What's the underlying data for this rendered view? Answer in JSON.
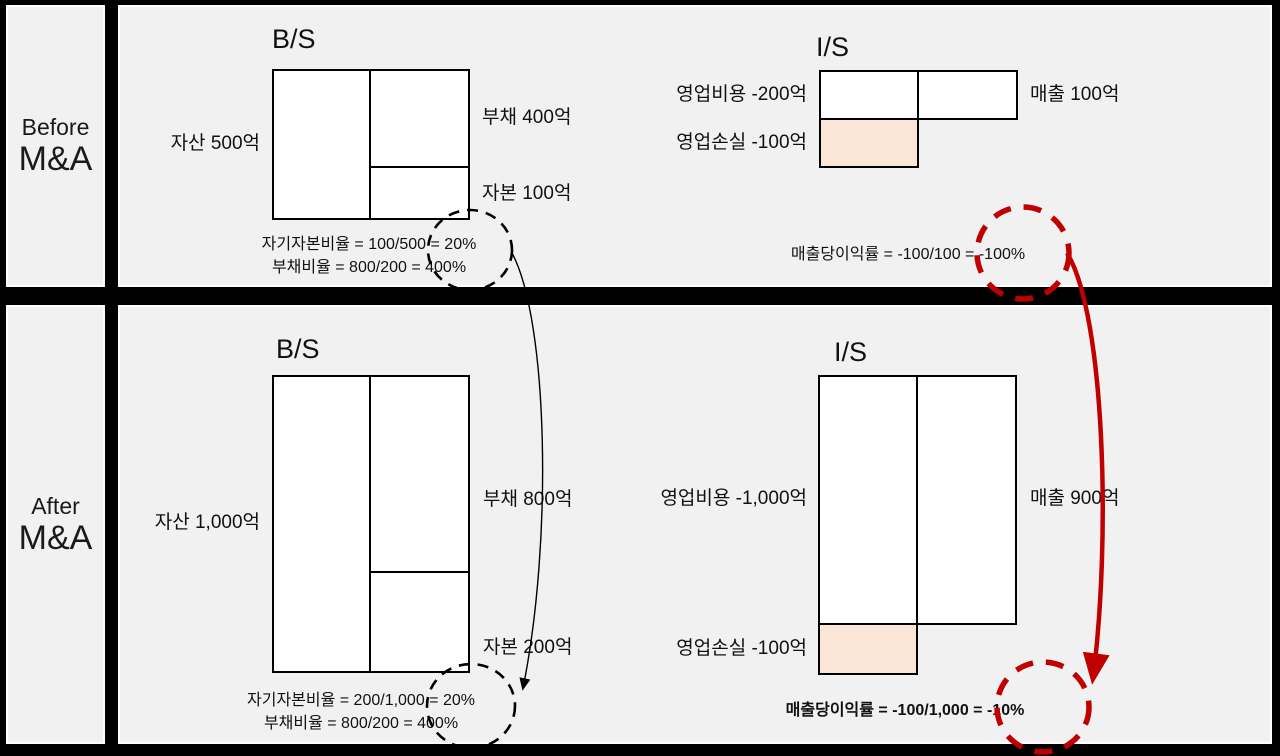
{
  "colors": {
    "accent_red": "#c00000",
    "loss_fill": "#fbe5d6",
    "cell_background": "#f1f1f2",
    "frame": "#000000"
  },
  "sections": [
    {
      "label_top": "Before",
      "label_bottom": "M&A",
      "bs": {
        "title": "B/S",
        "asset": "자산 500억",
        "debt": "부채 400억",
        "equity": "자본 100억",
        "equity_ratio": "자기자본비율 = 100/500 = 20%",
        "debt_ratio": "부채비율 = 800/200 = 400%"
      },
      "is": {
        "title": "I/S",
        "expense": "영업비용 -200억",
        "loss": "영업손실 -100억",
        "revenue": "매출 100억",
        "margin": "매출당이익률 = -100/100 = -100%"
      }
    },
    {
      "label_top": "After",
      "label_bottom": "M&A",
      "bs": {
        "title": "B/S",
        "asset": "자산 1,000억",
        "debt": "부채 800억",
        "equity": "자본 200억",
        "equity_ratio": "자기자본비율 = 200/1,000 = 20%",
        "debt_ratio": "부채비율 = 800/200 = 400%"
      },
      "is": {
        "title": "I/S",
        "expense": "영업비용 -1,000억",
        "loss": "영업손실 -100억",
        "revenue": "매출 900억",
        "margin": "매출당이익률 = -100/1,000 = -10%"
      }
    }
  ]
}
